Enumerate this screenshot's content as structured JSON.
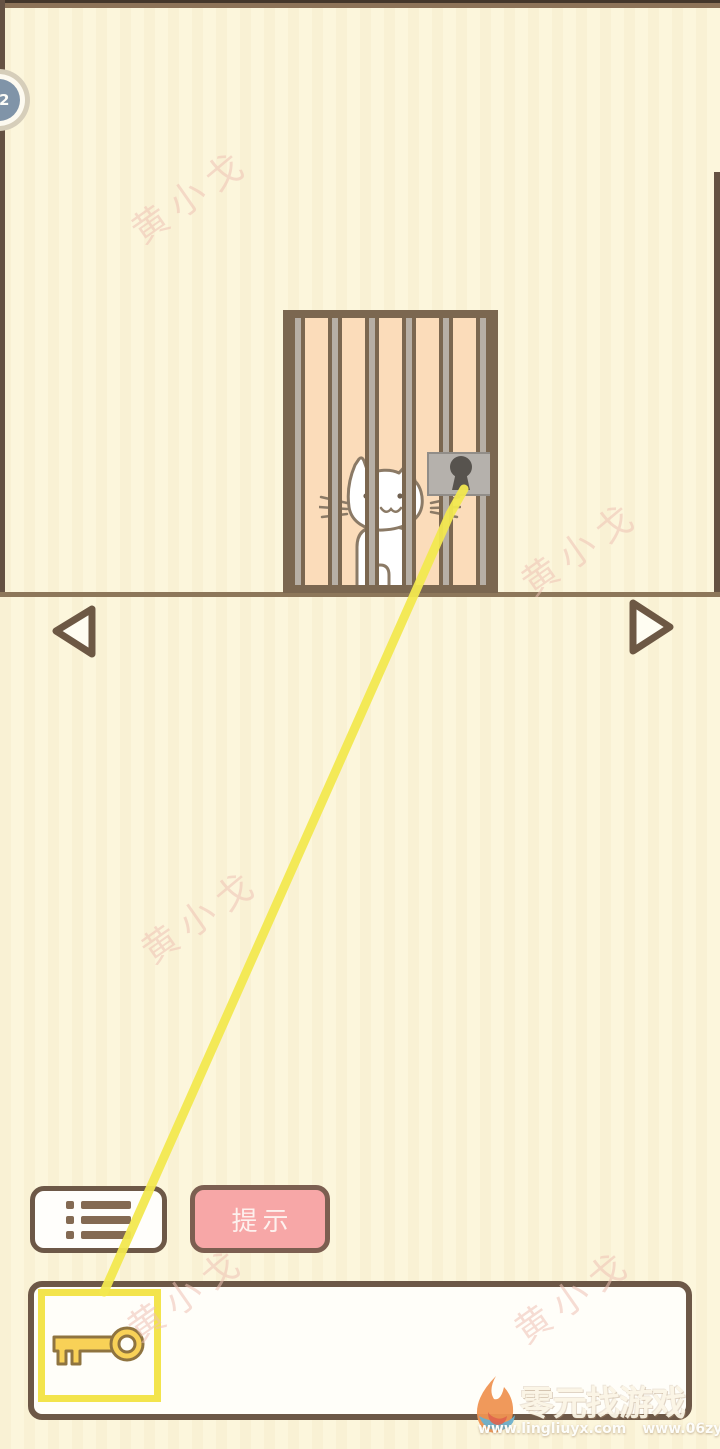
{
  "badge": {
    "level": "22"
  },
  "watermark": {
    "text": "黄小戈",
    "color": "#efc2b5"
  },
  "scene": {
    "cat": "white-cat-in-cage",
    "lock": "gray-padlock",
    "drag_line_color": "#f2e84f"
  },
  "nav": {
    "prev": "previous-level",
    "next": "next-level"
  },
  "toolbar": {
    "menu": "item-list-menu",
    "hint_label": "提示"
  },
  "inventory": {
    "items": [
      {
        "name": "key",
        "selected": true
      }
    ],
    "selected_border_color": "#f3e44c"
  },
  "footer": {
    "title": "零元找游戏",
    "url_left": "www.lingliuyx.com",
    "url_right": "www.06zyx.com"
  },
  "colors": {
    "background": "#fcf6dc",
    "cage_fill": "#fbdcba",
    "frame_brown": "#7b6750",
    "bar_gray": "#b7afa5",
    "hint_pink": "#f7a7a7",
    "key_gold": "#f8d157",
    "badge_blue": "#8094a8"
  }
}
